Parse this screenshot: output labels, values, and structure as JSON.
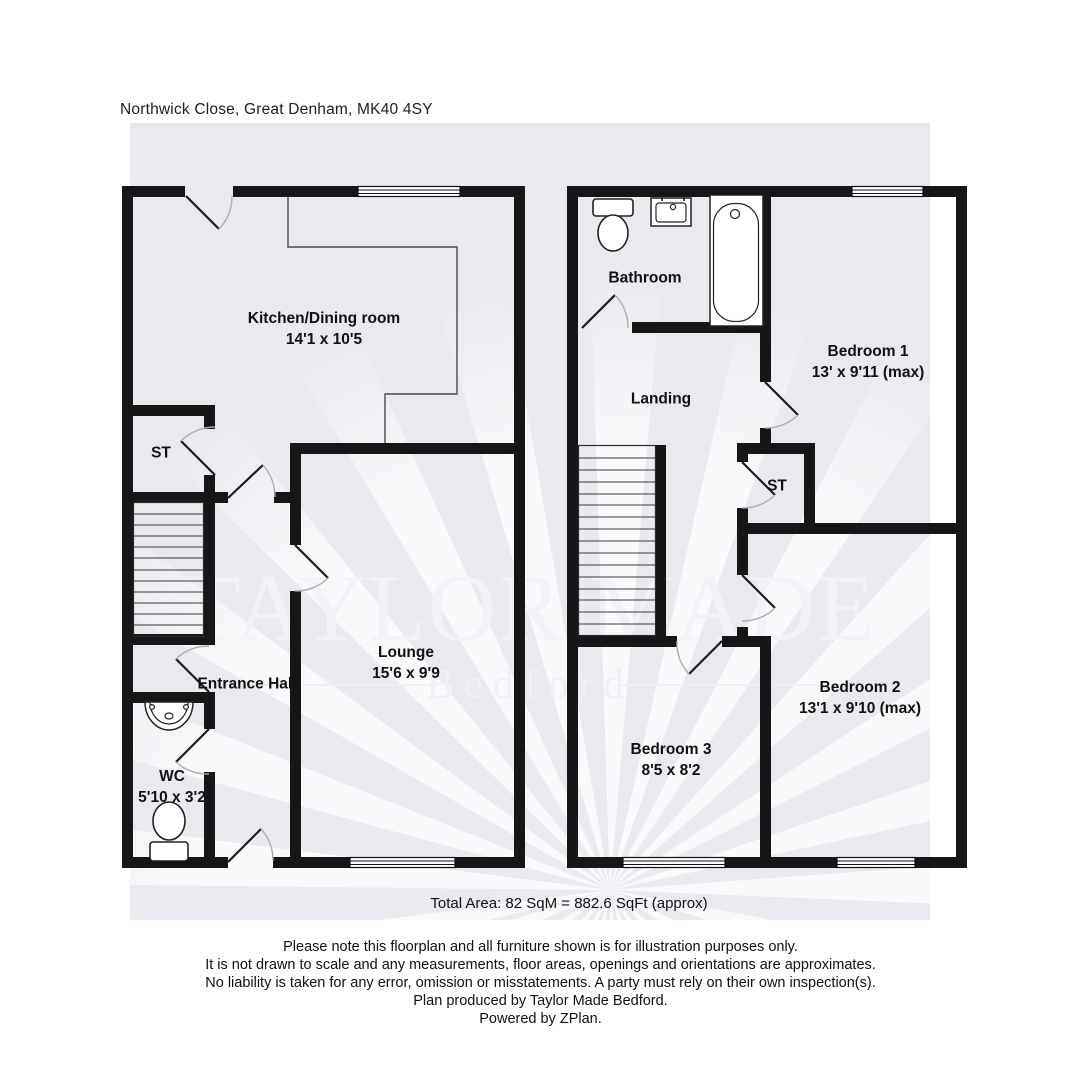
{
  "address": "Northwick Close, Great Denham, MK40 4SY",
  "watermark": {
    "line1": "TAYLOR MADE",
    "line2": "Bedford"
  },
  "ground_floor": {
    "kitchen": {
      "name": "Kitchen/Dining room",
      "dims": "14'1 x 10'5"
    },
    "storage": {
      "name": "ST"
    },
    "entrance_hall": {
      "name": "Entrance Hall"
    },
    "wc": {
      "name": "WC",
      "dims": "5'10 x 3'2"
    },
    "lounge": {
      "name": "Lounge",
      "dims": "15'6 x 9'9"
    }
  },
  "first_floor": {
    "bathroom": {
      "name": "Bathroom"
    },
    "landing": {
      "name": "Landing"
    },
    "storage": {
      "name": "ST"
    },
    "bedroom1": {
      "name": "Bedroom 1",
      "dims": "13' x 9'11 (max)"
    },
    "bedroom2": {
      "name": "Bedroom 2",
      "dims": "13'1 x 9'10 (max)"
    },
    "bedroom3": {
      "name": "Bedroom 3",
      "dims": "8'5 x 8'2"
    }
  },
  "footer": {
    "total_area": "Total Area: 82 SqM = 882.6 SqFt (approx)",
    "disclaimer": [
      "Please note this floorplan and all furniture shown is for illustration purposes only.",
      "It is not drawn to scale and any measurements, floor areas, openings and orientations are approximates.",
      "No liability is taken for any error, omission or misstatements. A party must rely on their own inspection(s).",
      "Plan produced by Taylor Made Bedford.",
      "Powered by ZPlan."
    ]
  },
  "colors": {
    "wall": "#161616",
    "backdrop": "#e8eaef",
    "watermark": "#f0f2f7"
  }
}
